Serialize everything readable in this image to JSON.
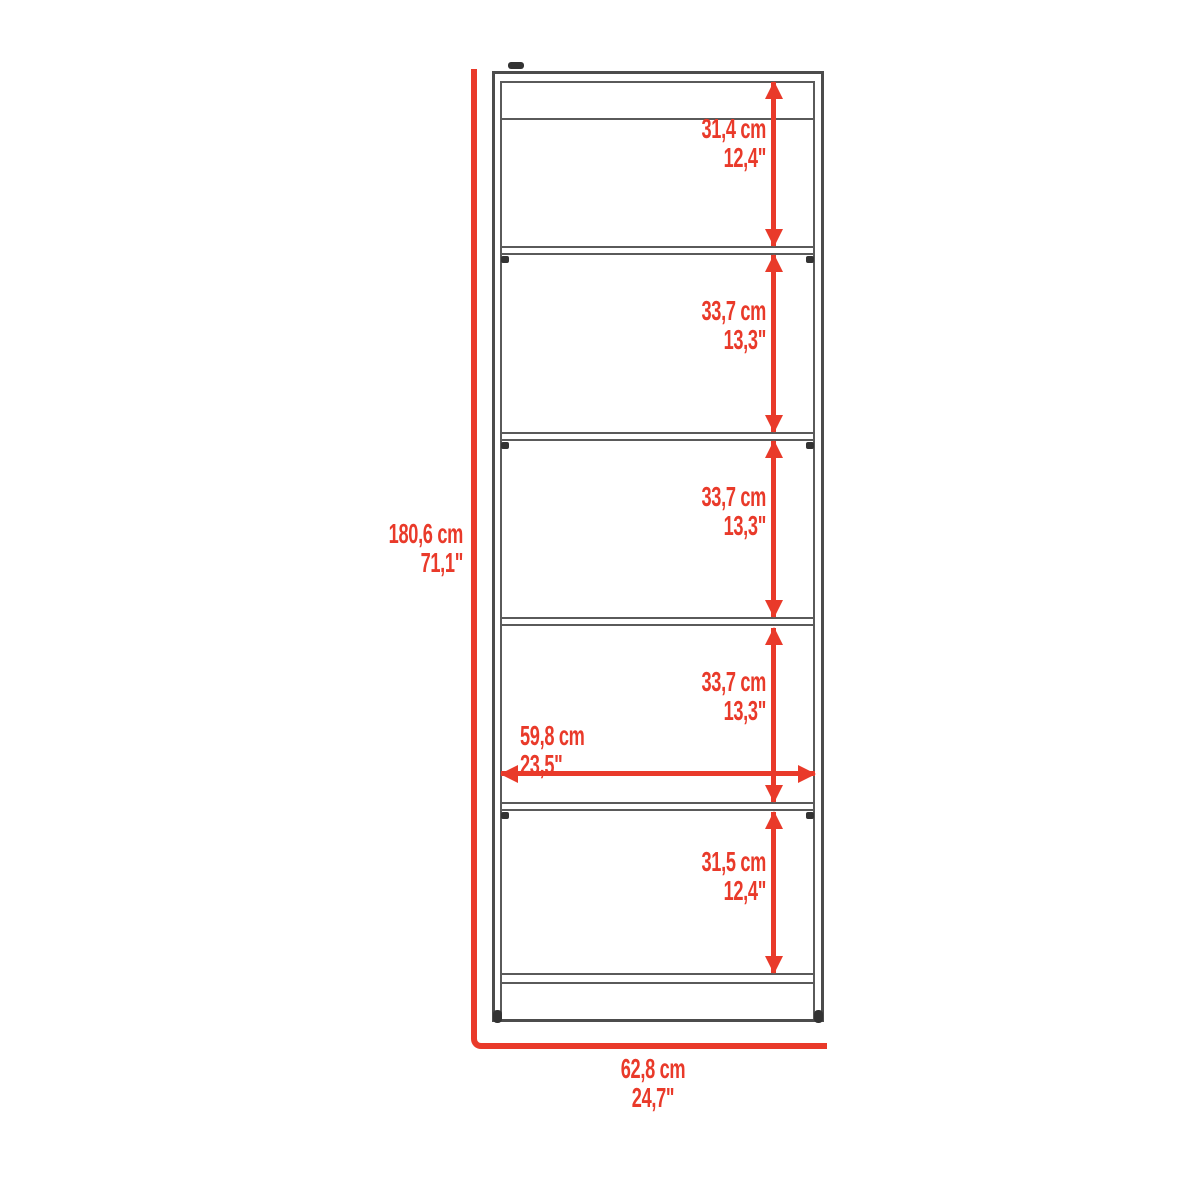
{
  "diagram": {
    "kind": "furniture-dimension-drawing",
    "subject": "bookcase with five shelf openings"
  },
  "colors": {
    "dimension_red": "#e93a2a",
    "outline_gray": "#4c4c4c",
    "background": "#ffffff"
  },
  "icons": {
    "arrow_up": "▲",
    "arrow_down": "▼",
    "arrow_left": "◄",
    "arrow_right": "►"
  },
  "overall": {
    "height_cm": "180,6 cm",
    "height_in": "71,1\"",
    "width_cm": "62,8 cm",
    "width_in": "24,7\""
  },
  "interior_width": {
    "cm": "59,8 cm",
    "in": "23,5\""
  },
  "sections": [
    {
      "cm": "31,4 cm",
      "in": "12,4\""
    },
    {
      "cm": "33,7 cm",
      "in": "13,3\""
    },
    {
      "cm": "33,7 cm",
      "in": "13,3\""
    },
    {
      "cm": "33,7 cm",
      "in": "13,3\""
    },
    {
      "cm": "31,5 cm",
      "in": "12,4\""
    }
  ]
}
